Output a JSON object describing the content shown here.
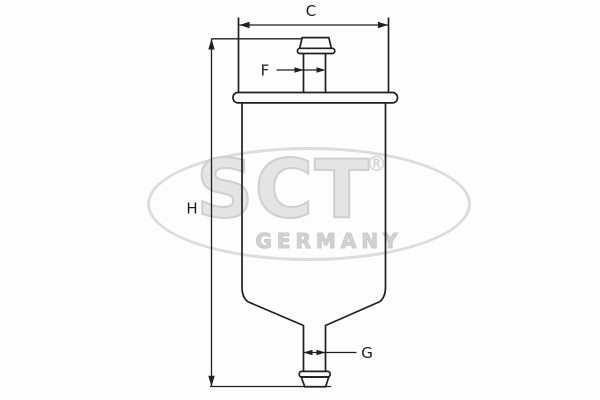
{
  "diagram": {
    "description": "fuel-filter technical outline drawing",
    "labels": {
      "c": "C",
      "f": "F",
      "h": "H",
      "g": "G"
    },
    "watermark": {
      "brand": "SCT",
      "registered": "®",
      "country": "GERMANY"
    },
    "colors": {
      "line": "#1f1f1f",
      "watermark_fill": "#e4e4e4",
      "watermark_stroke": "#cfcfcf",
      "background": "#fdfdfd"
    }
  }
}
